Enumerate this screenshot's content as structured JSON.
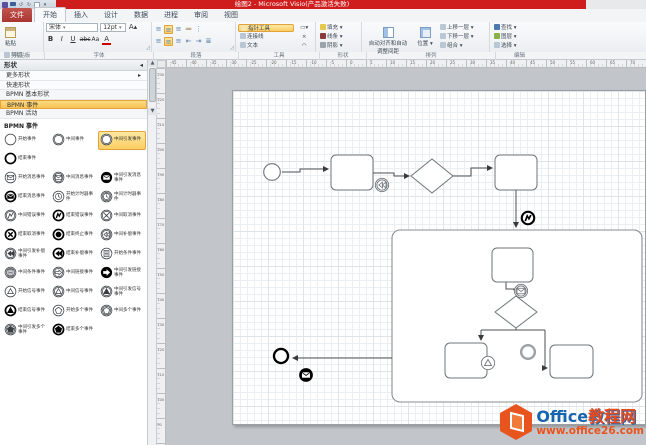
{
  "window": {
    "title": "绘图2 - Microsoft Visio(产品激活失败)"
  },
  "ribbon": {
    "tabs": [
      {
        "label": "文件",
        "file": true
      },
      {
        "label": "开始",
        "active": true
      },
      {
        "label": "插入"
      },
      {
        "label": "设计"
      },
      {
        "label": "数据"
      },
      {
        "label": "进程"
      },
      {
        "label": "审阅"
      },
      {
        "label": "视图"
      }
    ],
    "clipboard": {
      "label": "剪贴板",
      "paste": "粘贴",
      "cut": "剪切",
      "copy": "复制",
      "painter": "格式刷"
    },
    "font": {
      "label": "字体",
      "family": "宋体",
      "size": "12pt",
      "bold": "B",
      "italic": "I",
      "underline": "U",
      "strike": "abc",
      "case": "Aa",
      "color": "A"
    },
    "paragraph": {
      "label": "段落"
    },
    "tools": {
      "label": "工具",
      "pointer": "指针工具",
      "connector": "连接线",
      "text": "文本"
    },
    "shape": {
      "label": "形状",
      "fill": "填充",
      "line": "线条",
      "shadow": "阴影"
    },
    "arrange": {
      "label": "排列",
      "auto_align": "自动对齐和自动调整间距",
      "position": "位置",
      "bring_forward": "上移一层",
      "send_backward": "下移一层",
      "group": "组合"
    },
    "editing": {
      "label": "编辑",
      "find": "查找",
      "layers": "图层",
      "select": "选择"
    }
  },
  "shapes_panel": {
    "header": "形状",
    "more_shapes": "更多形状",
    "quick_shapes": "快速形状",
    "stencils": [
      {
        "label": "BPMN 基本形状"
      },
      {
        "label": "BPMN 事件",
        "active": true
      },
      {
        "label": "BPMN 活动"
      }
    ],
    "section": "BPMN 事件",
    "items": [
      {
        "label": "开始事件",
        "ring": "thin"
      },
      {
        "label": "中间事件",
        "ring": "double"
      },
      {
        "label": "中间引发事件",
        "ring": "double",
        "selected": true
      },
      {
        "label": "结束事件",
        "ring": "thick",
        "break_after": true
      },
      {
        "label": "开始消息事件",
        "ring": "thin",
        "glyph": "message"
      },
      {
        "label": "中间消息事件",
        "ring": "double",
        "glyph": "message"
      },
      {
        "label": "中间引发消息事件",
        "ring": "disc",
        "glyph": "message"
      },
      {
        "label": "结束消息事件",
        "ring": "thick",
        "glyph": "message",
        "glyph_filled": true
      },
      {
        "label": "开始计时器事件",
        "ring": "thin",
        "glyph": "timer"
      },
      {
        "label": "中间计时器事件",
        "ring": "double",
        "glyph": "timer"
      },
      {
        "label": "中间错误事件",
        "ring": "double",
        "glyph": "error"
      },
      {
        "label": "结束错误事件",
        "ring": "thick",
        "glyph": "error",
        "glyph_filled": true
      },
      {
        "label": "中间取消事件",
        "ring": "double",
        "glyph": "cancel"
      },
      {
        "label": "结束取消事件",
        "ring": "thick",
        "glyph": "cancel",
        "glyph_filled": true
      },
      {
        "label": "结束终止事件",
        "ring": "thick",
        "glyph": "terminate",
        "glyph_filled": true
      },
      {
        "label": "中间补偿事件",
        "ring": "double",
        "glyph": "compensation"
      },
      {
        "label": "中间引发补偿事件",
        "ring": "double",
        "glyph": "compensation",
        "glyph_filled": true
      },
      {
        "label": "结束补偿事件",
        "ring": "thick",
        "glyph": "compensation",
        "glyph_filled": true
      },
      {
        "label": "开始条件事件",
        "ring": "thin",
        "glyph": "conditional"
      },
      {
        "label": "中间条件事件",
        "ring": "double",
        "glyph": "conditional"
      },
      {
        "label": "中间链接事件",
        "ring": "double",
        "glyph": "link"
      },
      {
        "label": "中间引发链接事件",
        "ring": "disc",
        "glyph": "link"
      },
      {
        "label": "开始信号事件",
        "ring": "thin",
        "glyph": "signal"
      },
      {
        "label": "中间信号事件",
        "ring": "double",
        "glyph": "signal"
      },
      {
        "label": "中间引发信号事件",
        "ring": "double",
        "glyph": "signal",
        "glyph_filled": true
      },
      {
        "label": "结束信号事件",
        "ring": "thick",
        "glyph": "signal",
        "glyph_filled": true
      },
      {
        "label": "开始多个事件",
        "ring": "thin",
        "glyph": "multiple"
      },
      {
        "label": "中间多个事件",
        "ring": "double",
        "glyph": "multiple"
      },
      {
        "label": "中间引发多个事件",
        "ring": "double",
        "glyph": "multiple",
        "glyph_filled": true
      },
      {
        "label": "结束多个事件",
        "ring": "thick",
        "glyph": "multiple",
        "glyph_filled": true
      }
    ]
  },
  "canvas": {
    "h_ruler": [
      "-45",
      "-40",
      "-35",
      "-30",
      "-25",
      "-20",
      "-15",
      "-10",
      "-5",
      "0",
      "5",
      "10",
      "15",
      "20",
      "25",
      "30",
      "35",
      "40",
      "45",
      "50",
      "55",
      "60",
      "65",
      "70"
    ],
    "v_ruler": [
      "230",
      "220",
      "210",
      "200",
      "190",
      "180",
      "170",
      "160",
      "150",
      "140",
      "130",
      "120",
      "110",
      "100",
      "90"
    ]
  },
  "diagram": {
    "subprocess": {
      "x": 226,
      "y": 162,
      "w": 250,
      "h": 172
    },
    "nodes": [
      {
        "type": "event",
        "ring": "thin",
        "x": 106,
        "y": 104,
        "r": 10
      },
      {
        "type": "task",
        "x": 165,
        "y": 87,
        "w": 42,
        "h": 35
      },
      {
        "type": "event",
        "ring": "double",
        "glyph": "compensation",
        "x": 216,
        "y": 117,
        "r": 8
      },
      {
        "type": "gateway",
        "cx": 266,
        "cy": 108,
        "rx": 21,
        "ry": 17
      },
      {
        "type": "task",
        "x": 329,
        "y": 87,
        "w": 42,
        "h": 35
      },
      {
        "type": "event",
        "ring": "thick",
        "glyph": "error",
        "x": 362,
        "y": 150,
        "r": 8
      },
      {
        "type": "task",
        "x": 326,
        "y": 180,
        "w": 41,
        "h": 34
      },
      {
        "type": "event",
        "ring": "double",
        "glyph": "message",
        "x": 355,
        "y": 223,
        "r": 8
      },
      {
        "type": "gateway",
        "cx": 350,
        "cy": 244,
        "rx": 21,
        "ry": 16
      },
      {
        "type": "task",
        "x": 279,
        "y": 275,
        "w": 42,
        "h": 35
      },
      {
        "type": "task",
        "x": 384,
        "y": 277,
        "w": 43,
        "h": 33
      },
      {
        "type": "event",
        "ring": "thin",
        "glyph": "signal",
        "x": 322,
        "y": 295,
        "r": 8
      },
      {
        "type": "event",
        "ring": "gray",
        "x": 362,
        "y": 284,
        "r": 9
      },
      {
        "type": "event",
        "ring": "thick",
        "x": 115,
        "y": 288,
        "r": 9
      },
      {
        "type": "event",
        "ring": "disc",
        "glyph": "message",
        "x": 140,
        "y": 307,
        "r": 8
      }
    ],
    "connectors": [
      {
        "pts": [
          [
            116,
            104
          ],
          [
            134,
            104
          ],
          [
            134,
            101
          ],
          [
            162,
            101
          ]
        ],
        "arrow": true
      },
      {
        "pts": [
          [
            207,
            105
          ],
          [
            228,
            105
          ],
          [
            228,
            108
          ],
          [
            243,
            108
          ]
        ],
        "arrow": true
      },
      {
        "pts": [
          [
            287,
            108
          ],
          [
            305,
            108
          ],
          [
            305,
            100
          ],
          [
            326,
            100
          ]
        ],
        "arrow": true
      },
      {
        "pts": [
          [
            350,
            122
          ],
          [
            350,
            159
          ]
        ],
        "arrow": true
      },
      {
        "pts": [
          [
            226,
            290
          ],
          [
            127,
            290
          ]
        ],
        "arrow": true
      },
      {
        "pts": [
          [
            340,
            214
          ],
          [
            340,
            221
          ],
          [
            350,
            221
          ],
          [
            350,
            226
          ]
        ],
        "arrow": true
      },
      {
        "pts": [
          [
            350,
            260
          ],
          [
            350,
            262
          ]
        ],
        "arrow": false
      },
      {
        "pts": [
          [
            315,
            262
          ],
          [
            379,
            262
          ]
        ],
        "arrow": false
      },
      {
        "pts": [
          [
            315,
            262
          ],
          [
            315,
            272
          ]
        ],
        "arrow": true
      },
      {
        "pts": [
          [
            379,
            262
          ],
          [
            379,
            300
          ],
          [
            381,
            300
          ]
        ],
        "arrow": true
      }
    ]
  },
  "watermark": {
    "brand_en": "Office",
    "brand_cn": "教程网",
    "url": "www.office26.com"
  },
  "colors": {
    "titlebar": "#cf1d1d",
    "highlight": "#fbce63",
    "accent_orange": "#e8541d",
    "brand_blue": "#1765ae",
    "shape_stroke": "#70767c"
  }
}
